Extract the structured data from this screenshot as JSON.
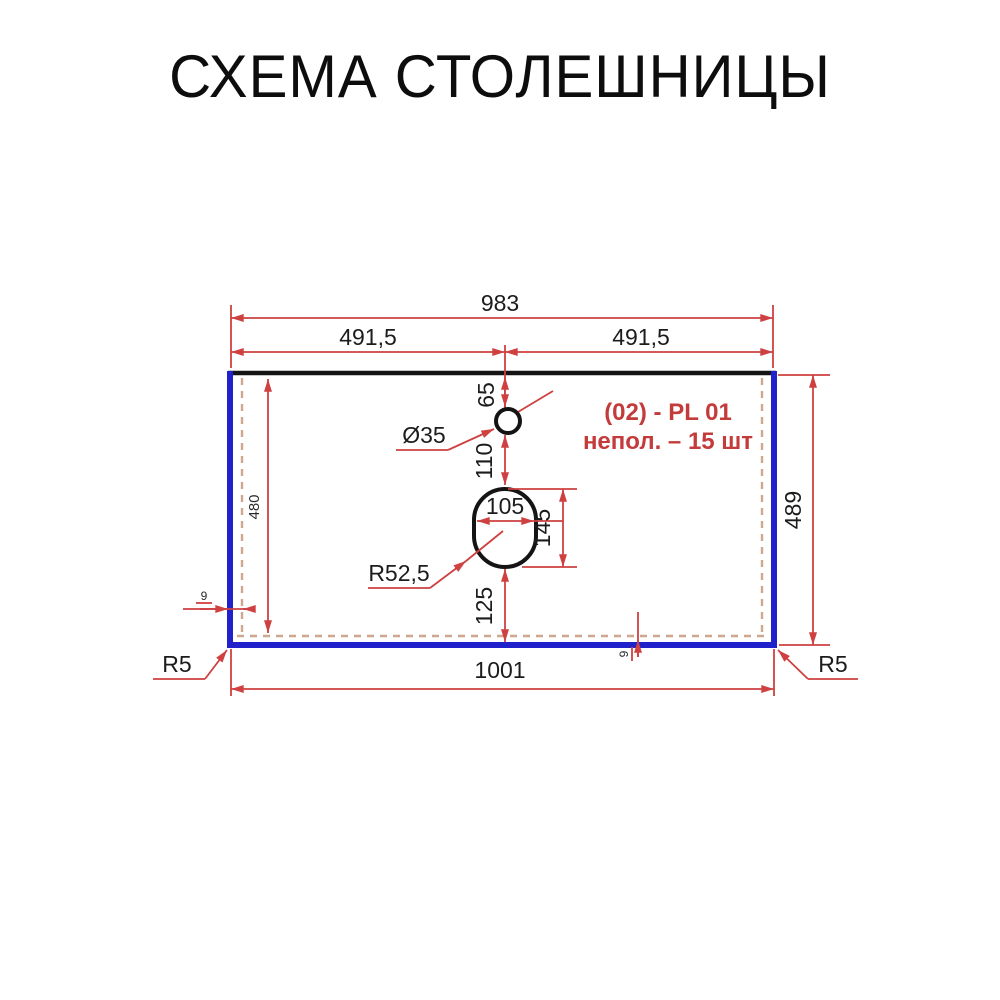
{
  "title": "СХЕМА СТОЛЕШНИЦЫ",
  "part_label": {
    "line1": "(02) - PL 01",
    "line2": "непол. – 15 шт"
  },
  "dimensions": {
    "top_width": "983",
    "half_width_left": "491,5",
    "half_width_right": "491,5",
    "faucet_offset_from_top": "65",
    "faucet_hole_diameter": "Ø35",
    "faucet_to_drain": "110",
    "drain_hole_width": "105",
    "drain_hole_height": "145",
    "drain_corner_radius": "R52,5",
    "drain_to_bottom": "125",
    "inner_height": "480",
    "outer_height": "489",
    "edge_band_left": "9",
    "edge_band_bottom": "9",
    "bottom_width": "1001",
    "corner_radius_bl": "R5",
    "corner_radius_br": "R5"
  },
  "colors": {
    "dimension_red": "#cf4040",
    "annotation_red": "#c43b3b",
    "edge_blue": "#2121cc",
    "outline_black": "#141414",
    "dashed_inner": "#bd8a68",
    "text": "#1c1c1c",
    "background": "#ffffff"
  }
}
